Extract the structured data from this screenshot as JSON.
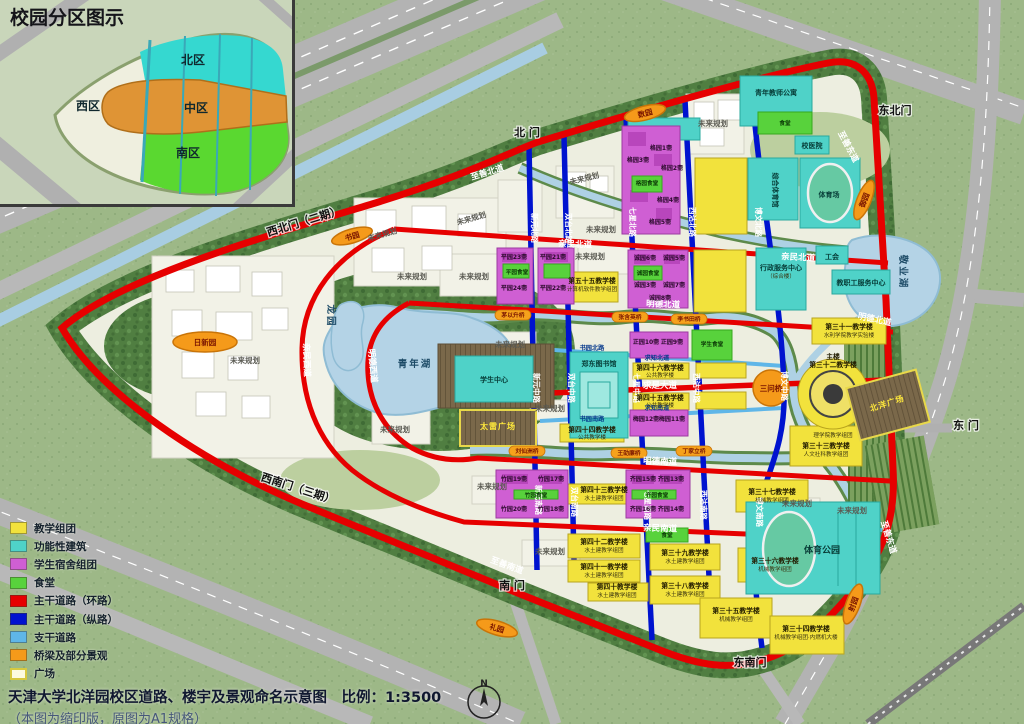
{
  "inset": {
    "title": "校园分区图示",
    "regions": [
      {
        "label": "北区",
        "x": 193,
        "y": 64
      },
      {
        "label": "西区",
        "x": 88,
        "y": 110
      },
      {
        "label": "中区",
        "x": 196,
        "y": 112
      },
      {
        "label": "南区",
        "x": 188,
        "y": 157
      }
    ]
  },
  "legend": {
    "items": [
      {
        "label": "教学组团",
        "color": "#f2e23c"
      },
      {
        "label": "功能性建筑",
        "color": "#4fd2c8"
      },
      {
        "label": "学生宿舍组团",
        "color": "#cf5fd3"
      },
      {
        "label": "食堂",
        "color": "#58d23c"
      },
      {
        "label": "主干道路（环路）",
        "color": "#e60000"
      },
      {
        "label": "主干道路（纵路）",
        "color": "#0013cf"
      },
      {
        "label": "支干道路",
        "color": "#5fb6e8"
      },
      {
        "label": "桥梁及部分景观",
        "color": "#f59a1a"
      },
      {
        "label": "广场",
        "color": "#fdfbe0",
        "border": "#d6c840"
      }
    ]
  },
  "footer": {
    "title": "天津大学北洋园校区道路、楼宇及景观命名示意图",
    "scale_label": "比例：1:3500",
    "subtitle": "（本图为缩印版，原图为A1规格）",
    "compass": "N"
  },
  "colors": {
    "ring_road": "#e60000",
    "main_road_ns": "#0013cf",
    "branch_road": "#5fb6e8",
    "bridge_orange": "#f59a1a",
    "teaching_yellow": "#f2e23c",
    "functional_cyan": "#4fd2c8",
    "dorm_magenta": "#cf5fd3",
    "canteen_green": "#58d23c",
    "water": "#b4d3e6"
  },
  "map": {
    "labels": [
      {
        "t": "北  门",
        "x": 527,
        "y": 136,
        "c": "gate"
      },
      {
        "t": "东北门",
        "x": 895,
        "y": 114,
        "c": "gate"
      },
      {
        "t": "西北门（二期）",
        "x": 305,
        "y": 225,
        "c": "gate",
        "r": -17
      },
      {
        "t": "东  门",
        "x": 966,
        "y": 429,
        "c": "gate"
      },
      {
        "t": "西南门（三期）",
        "x": 297,
        "y": 492,
        "c": "gate",
        "r": 18
      },
      {
        "t": "南  门",
        "x": 512,
        "y": 589,
        "c": "gate"
      },
      {
        "t": "东南门",
        "x": 750,
        "y": 666,
        "c": "gate"
      },
      {
        "t": "至善北道",
        "x": 488,
        "y": 175,
        "c": "road-red",
        "r": -17
      },
      {
        "t": "至善东道",
        "x": 846,
        "y": 148,
        "c": "road-red",
        "r": 62
      },
      {
        "t": "至善东道",
        "x": 886,
        "y": 538,
        "c": "road-red",
        "r": 73
      },
      {
        "t": "至善南道",
        "x": 506,
        "y": 568,
        "c": "road-red",
        "r": 20
      },
      {
        "t": "亲民北道",
        "x": 575,
        "y": 247,
        "c": "road-red",
        "r": 2
      },
      {
        "t": "亲民北道",
        "x": 798,
        "y": 260,
        "c": "road-red",
        "r": 3
      },
      {
        "t": "明德北道",
        "x": 663,
        "y": 307,
        "c": "road-red",
        "r": 2
      },
      {
        "t": "明德北道",
        "x": 874,
        "y": 322,
        "c": "road-red",
        "r": 12
      },
      {
        "t": "求是大道",
        "x": 660,
        "y": 388,
        "c": "road-red"
      },
      {
        "t": "明德南道",
        "x": 660,
        "y": 464,
        "c": "road-red",
        "r": 2
      },
      {
        "t": "亲民南道",
        "x": 660,
        "y": 531,
        "c": "road-red",
        "r": 2
      },
      {
        "t": "明德西道",
        "x": 370,
        "y": 366,
        "c": "road-red",
        "r": 85
      },
      {
        "t": "亲民西道",
        "x": 304,
        "y": 360,
        "c": "road-red",
        "r": 88
      },
      {
        "t": "新元北路",
        "x": 532,
        "y": 228,
        "c": "road-blue",
        "r": 90
      },
      {
        "t": "新元中路",
        "x": 534,
        "y": 388,
        "c": "road-blue",
        "r": 90
      },
      {
        "t": "新元南路",
        "x": 536,
        "y": 500,
        "c": "road-blue",
        "r": 90
      },
      {
        "t": "双台北路",
        "x": 566,
        "y": 228,
        "c": "road-blue",
        "r": 90
      },
      {
        "t": "双台中路",
        "x": 569,
        "y": 388,
        "c": "road-blue",
        "r": 90
      },
      {
        "t": "双台南路",
        "x": 572,
        "y": 502,
        "c": "road-blue",
        "r": 90
      },
      {
        "t": "七星北路",
        "x": 630,
        "y": 222,
        "c": "road-blue",
        "r": 90
      },
      {
        "t": "七星中路",
        "x": 634,
        "y": 388,
        "c": "road-blue",
        "r": 90
      },
      {
        "t": "七星南路",
        "x": 645,
        "y": 505,
        "c": "road-blue",
        "r": 90
      },
      {
        "t": "西沽北路",
        "x": 690,
        "y": 222,
        "c": "road-blue",
        "r": 90
      },
      {
        "t": "西沽中路",
        "x": 694,
        "y": 388,
        "c": "road-blue",
        "r": 90
      },
      {
        "t": "西沽南路",
        "x": 701,
        "y": 505,
        "c": "road-blue",
        "r": 90
      },
      {
        "t": "博文北路",
        "x": 756,
        "y": 222,
        "c": "road-blue",
        "r": 90
      },
      {
        "t": "博文中路",
        "x": 782,
        "y": 386,
        "c": "road-blue",
        "r": 90
      },
      {
        "t": "博文南路",
        "x": 757,
        "y": 512,
        "c": "road-blue",
        "r": 90
      },
      {
        "t": "书园北路",
        "x": 592,
        "y": 350,
        "c": "road-cyan"
      },
      {
        "t": "书园南路",
        "x": 592,
        "y": 421,
        "c": "road-cyan"
      },
      {
        "t": "求知北道",
        "x": 657,
        "y": 360,
        "c": "road-cyan"
      },
      {
        "t": "求知南道",
        "x": 657,
        "y": 410,
        "c": "road-cyan"
      },
      {
        "t": "青年湖",
        "x": 415,
        "y": 367,
        "c": "lake"
      },
      {
        "t": "龙园",
        "x": 328,
        "y": 316,
        "c": "lake",
        "r": 90
      },
      {
        "t": "敬业湖",
        "x": 900,
        "y": 272,
        "c": "lake",
        "r": 90
      },
      {
        "t": "未来规划",
        "x": 383,
        "y": 237,
        "c": "future",
        "r": -16
      },
      {
        "t": "未来规划",
        "x": 472,
        "y": 221,
        "c": "future",
        "r": -16
      },
      {
        "t": "未来规划",
        "x": 412,
        "y": 279,
        "c": "future"
      },
      {
        "t": "未来规划",
        "x": 474,
        "y": 279,
        "c": "future"
      },
      {
        "t": "未来规划",
        "x": 585,
        "y": 181,
        "c": "future",
        "r": -14
      },
      {
        "t": "未来规划",
        "x": 713,
        "y": 126,
        "c": "future"
      },
      {
        "t": "未来规划",
        "x": 601,
        "y": 232,
        "c": "future"
      },
      {
        "t": "未来规划",
        "x": 245,
        "y": 363,
        "c": "future"
      },
      {
        "t": "未来规划",
        "x": 590,
        "y": 259,
        "c": "future"
      },
      {
        "t": "未来规划",
        "x": 510,
        "y": 347,
        "c": "future"
      },
      {
        "t": "未来规划",
        "x": 395,
        "y": 432,
        "c": "future"
      },
      {
        "t": "未来规划",
        "x": 550,
        "y": 411,
        "c": "future"
      },
      {
        "t": "未来规划",
        "x": 550,
        "y": 554,
        "c": "future"
      },
      {
        "t": "未来规划",
        "x": 492,
        "y": 489,
        "c": "future"
      },
      {
        "t": "未来规划",
        "x": 797,
        "y": 506,
        "c": "future"
      },
      {
        "t": "未来规划",
        "x": 852,
        "y": 513,
        "c": "future"
      },
      {
        "t": "第四十六教学楼",
        "x": 660,
        "y": 370,
        "c": "by"
      },
      {
        "t": "公共教学楼",
        "x": 660,
        "y": 377,
        "c": "bsub"
      },
      {
        "t": "第四十五教学楼",
        "x": 660,
        "y": 400,
        "c": "by"
      },
      {
        "t": "公共教学楼",
        "x": 660,
        "y": 407,
        "c": "bsub"
      },
      {
        "t": "第四十四教学楼",
        "x": 592,
        "y": 432,
        "c": "by"
      },
      {
        "t": "公共教学楼",
        "x": 592,
        "y": 439,
        "c": "bsub"
      },
      {
        "t": "第五十五教学楼",
        "x": 592,
        "y": 283,
        "c": "by"
      },
      {
        "t": "计算机软件教学组团",
        "x": 592,
        "y": 291,
        "c": "bsub"
      },
      {
        "t": "第四十三教学楼",
        "x": 604,
        "y": 492,
        "c": "by"
      },
      {
        "t": "水土建教学组团",
        "x": 604,
        "y": 500,
        "c": "bsub"
      },
      {
        "t": "第四十二教学楼",
        "x": 604,
        "y": 544,
        "c": "by"
      },
      {
        "t": "水土建教学组团",
        "x": 604,
        "y": 552,
        "c": "bsub"
      },
      {
        "t": "第四十一教学楼",
        "x": 604,
        "y": 569,
        "c": "by"
      },
      {
        "t": "水土建教学组团",
        "x": 604,
        "y": 577,
        "c": "bsub"
      },
      {
        "t": "第四十教学楼",
        "x": 617,
        "y": 589,
        "c": "by"
      },
      {
        "t": "水土建教学组团",
        "x": 617,
        "y": 597,
        "c": "bsub"
      },
      {
        "t": "第三十九教学楼",
        "x": 685,
        "y": 555,
        "c": "by"
      },
      {
        "t": "水土建教学组团",
        "x": 685,
        "y": 563,
        "c": "bsub"
      },
      {
        "t": "第三十八教学楼",
        "x": 685,
        "y": 588,
        "c": "by"
      },
      {
        "t": "水土建教学组团",
        "x": 685,
        "y": 596,
        "c": "bsub"
      },
      {
        "t": "第三十七教学楼",
        "x": 772,
        "y": 494,
        "c": "by"
      },
      {
        "t": "机械教学组团",
        "x": 772,
        "y": 502,
        "c": "bsub"
      },
      {
        "t": "第三十六教学楼",
        "x": 775,
        "y": 563,
        "c": "by"
      },
      {
        "t": "机械教学组团",
        "x": 775,
        "y": 571,
        "c": "bsub"
      },
      {
        "t": "第三十五教学楼",
        "x": 736,
        "y": 613,
        "c": "by"
      },
      {
        "t": "机械教学组团",
        "x": 736,
        "y": 621,
        "c": "bsub"
      },
      {
        "t": "第三十四教学楼",
        "x": 806,
        "y": 631,
        "c": "by"
      },
      {
        "t": "机械教学组团·内燃机大楼",
        "x": 806,
        "y": 639,
        "c": "bsub"
      },
      {
        "t": "第三十一教学楼",
        "x": 849,
        "y": 329,
        "c": "by"
      },
      {
        "t": "水利学院教学实验楼",
        "x": 849,
        "y": 337,
        "c": "bsub"
      },
      {
        "t": "主楼",
        "x": 833,
        "y": 359,
        "c": "by"
      },
      {
        "t": "第三十二教学楼",
        "x": 833,
        "y": 367,
        "c": "by"
      },
      {
        "t": "理学院教学组团",
        "x": 833,
        "y": 437,
        "c": "bsub"
      },
      {
        "t": "第三十三教学楼",
        "x": 826,
        "y": 448,
        "c": "by"
      },
      {
        "t": "人文社科教学组团",
        "x": 826,
        "y": 456,
        "c": "bsub"
      },
      {
        "t": "学生中心",
        "x": 494,
        "y": 382,
        "c": "bc"
      },
      {
        "t": "郑东图书馆",
        "x": 599,
        "y": 366,
        "c": "bc"
      },
      {
        "t": "行政服务中心",
        "x": 781,
        "y": 270,
        "c": "bc"
      },
      {
        "t": "（综合楼）",
        "x": 781,
        "y": 278,
        "c": "bsub"
      },
      {
        "t": "工会",
        "x": 832,
        "y": 259,
        "c": "bc"
      },
      {
        "t": "教职工服务中心",
        "x": 861,
        "y": 285,
        "c": "bc"
      },
      {
        "t": "校医院",
        "x": 812,
        "y": 148,
        "c": "bc"
      },
      {
        "t": "青年教师公寓",
        "x": 776,
        "y": 95,
        "c": "bc"
      },
      {
        "t": "综合体育馆",
        "x": 773,
        "y": 190,
        "c": "bc",
        "r": 90
      },
      {
        "t": "体育场",
        "x": 829,
        "y": 197,
        "c": "bc"
      },
      {
        "t": "体育公园",
        "x": 822,
        "y": 553,
        "c": "area"
      },
      {
        "t": "格园食堂",
        "x": 647,
        "y": 185,
        "c": "bgc"
      },
      {
        "t": "诚园食堂",
        "x": 648,
        "y": 275,
        "c": "bgc"
      },
      {
        "t": "平园食堂",
        "x": 517,
        "y": 274,
        "c": "bgc"
      },
      {
        "t": "学生食堂",
        "x": 712,
        "y": 346,
        "c": "bgc"
      },
      {
        "t": "食堂",
        "x": 785,
        "y": 125,
        "c": "bgc"
      },
      {
        "t": "食堂",
        "x": 667,
        "y": 537,
        "c": "bgc"
      },
      {
        "t": "竹园食堂",
        "x": 536,
        "y": 497,
        "c": "bgc"
      },
      {
        "t": "齐园食堂",
        "x": 657,
        "y": 497,
        "c": "bgc"
      },
      {
        "t": "格园1斋",
        "x": 661,
        "y": 150,
        "c": "bm"
      },
      {
        "t": "格园2斋",
        "x": 672,
        "y": 170,
        "c": "bm"
      },
      {
        "t": "格园3斋",
        "x": 638,
        "y": 162,
        "c": "bm"
      },
      {
        "t": "格园4斋",
        "x": 668,
        "y": 202,
        "c": "bm"
      },
      {
        "t": "格园5斋",
        "x": 660,
        "y": 224,
        "c": "bm"
      },
      {
        "t": "诚园6斋",
        "x": 645,
        "y": 260,
        "c": "bm"
      },
      {
        "t": "诚园5斋",
        "x": 674,
        "y": 260,
        "c": "bm"
      },
      {
        "t": "诚园3斋",
        "x": 645,
        "y": 287,
        "c": "bm"
      },
      {
        "t": "诚园7斋",
        "x": 674,
        "y": 287,
        "c": "bm"
      },
      {
        "t": "诚园8斋",
        "x": 660,
        "y": 300,
        "c": "bm"
      },
      {
        "t": "平园23斋",
        "x": 514,
        "y": 259,
        "c": "bm"
      },
      {
        "t": "平园21斋",
        "x": 553,
        "y": 259,
        "c": "bm"
      },
      {
        "t": "平园24斋",
        "x": 514,
        "y": 290,
        "c": "bm"
      },
      {
        "t": "平园22斋",
        "x": 553,
        "y": 290,
        "c": "bm"
      },
      {
        "t": "正园10斋",
        "x": 646,
        "y": 344,
        "c": "bm"
      },
      {
        "t": "正园9斋",
        "x": 672,
        "y": 344,
        "c": "bm"
      },
      {
        "t": "梅园12斋",
        "x": 646,
        "y": 421,
        "c": "bm"
      },
      {
        "t": "梅园11斋",
        "x": 672,
        "y": 421,
        "c": "bm"
      },
      {
        "t": "竹园19斋",
        "x": 514,
        "y": 481,
        "c": "bm"
      },
      {
        "t": "竹园17斋",
        "x": 551,
        "y": 481,
        "c": "bm"
      },
      {
        "t": "竹园20斋",
        "x": 514,
        "y": 511,
        "c": "bm"
      },
      {
        "t": "竹园18斋",
        "x": 551,
        "y": 511,
        "c": "bm"
      },
      {
        "t": "齐园15斋",
        "x": 643,
        "y": 481,
        "c": "bm"
      },
      {
        "t": "齐园13斋",
        "x": 671,
        "y": 481,
        "c": "bm"
      },
      {
        "t": "齐园16斋",
        "x": 643,
        "y": 511,
        "c": "bm"
      },
      {
        "t": "齐园14斋",
        "x": 671,
        "y": 511,
        "c": "bm"
      },
      {
        "t": "太雷广场",
        "x": 498,
        "y": 429,
        "c": "plaza"
      },
      {
        "t": "北洋广场",
        "x": 888,
        "y": 406,
        "c": "plaza",
        "r": -18
      }
    ],
    "badges": [
      {
        "t": "日新园",
        "x": 205,
        "y": 342,
        "w": 64,
        "h": 20
      },
      {
        "t": "书园",
        "x": 352,
        "y": 236,
        "w": 42,
        "h": 14,
        "r": -16
      },
      {
        "t": "数园",
        "x": 645,
        "y": 113,
        "w": 42,
        "h": 14,
        "r": -14
      },
      {
        "t": "御园",
        "x": 864,
        "y": 200,
        "w": 42,
        "h": 14,
        "r": -68
      },
      {
        "t": "射园",
        "x": 853,
        "y": 604,
        "w": 42,
        "h": 14,
        "r": -70
      },
      {
        "t": "礼园",
        "x": 497,
        "y": 628,
        "w": 42,
        "h": 14,
        "r": 16
      },
      {
        "t": "三问桥",
        "x": 771,
        "y": 388,
        "w": 36,
        "h": 36,
        "shape": "circle"
      },
      {
        "t": "茅以升桥",
        "x": 513,
        "y": 315,
        "s": 1
      },
      {
        "t": "张含英桥",
        "x": 630,
        "y": 317,
        "s": 1
      },
      {
        "t": "李书田桥",
        "x": 689,
        "y": 319,
        "s": 1
      },
      {
        "t": "刘仙洲桥",
        "x": 527,
        "y": 451,
        "s": 1
      },
      {
        "t": "王劭廉桥",
        "x": 629,
        "y": 453,
        "s": 1
      },
      {
        "t": "丁家立桥",
        "x": 694,
        "y": 451,
        "s": 1
      }
    ]
  }
}
